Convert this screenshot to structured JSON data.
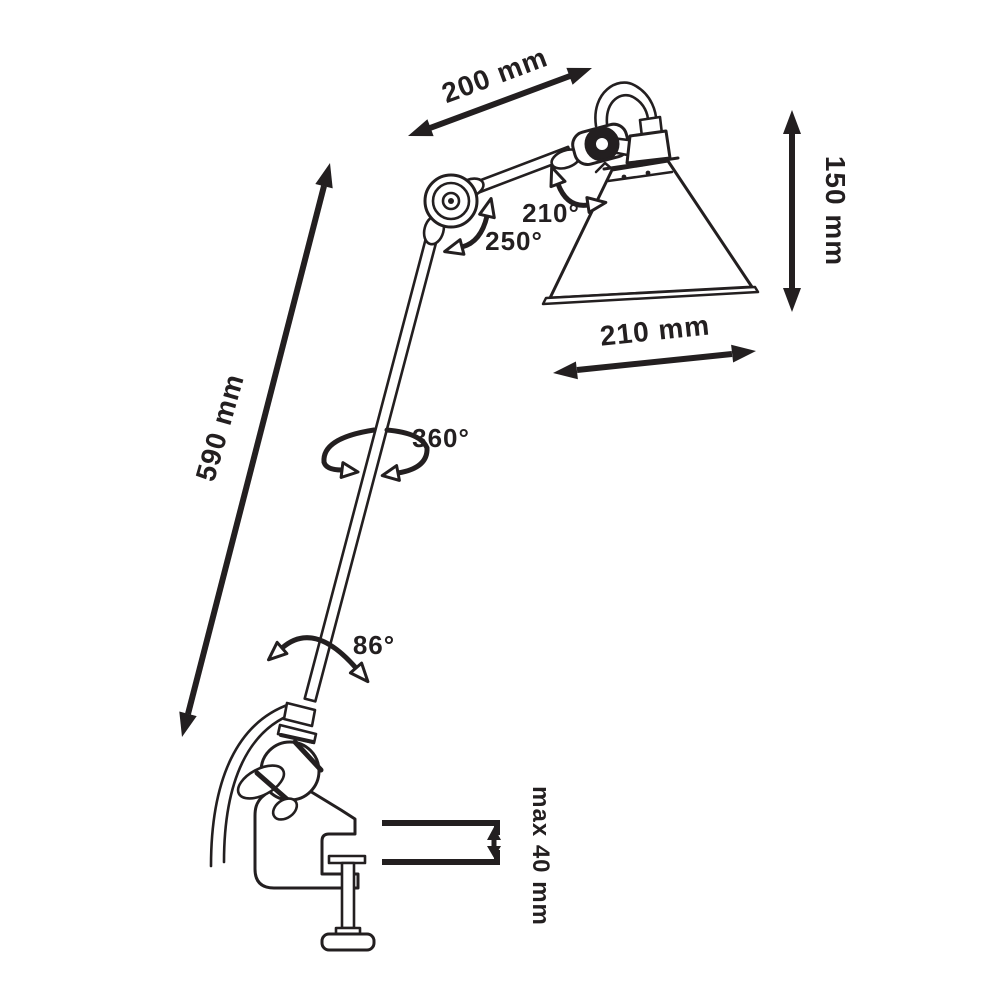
{
  "page": {
    "background": "#ffffff",
    "ink": "#231f20"
  },
  "diagram": {
    "type": "technical-dimension-drawing",
    "subject": "articulated clamp-mount lamp",
    "dimension_labels": {
      "upper_arm_length": "200 mm",
      "shade_height": "150 mm",
      "shade_diameter": "210 mm",
      "main_arm_length": "590 mm",
      "clamp_capacity": "max 40 mm"
    },
    "angle_labels": {
      "shade_tilt": "210°",
      "elbow_swing": "250°",
      "arm_rotation": "360°",
      "base_swing": "86°"
    }
  }
}
